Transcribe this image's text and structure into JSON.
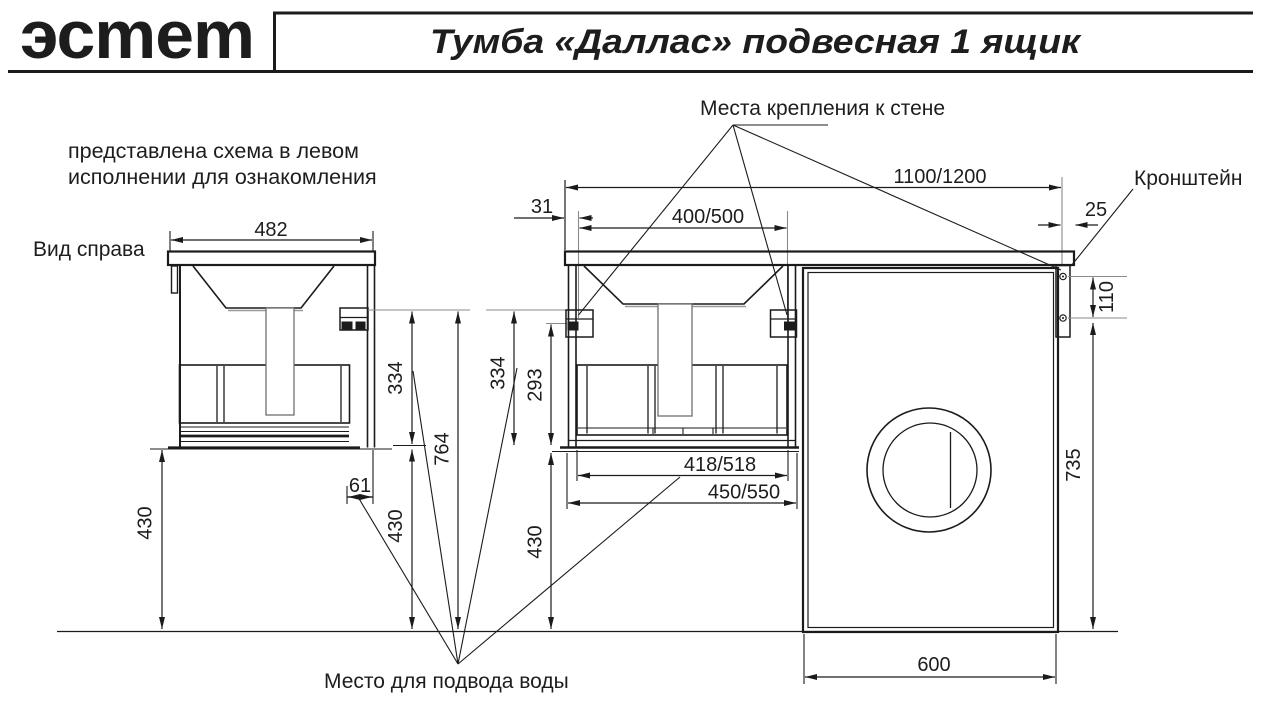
{
  "header": {
    "logo_text": "эсmеm",
    "title": "Тумба «Даллас» подвесная 1 ящик"
  },
  "note": {
    "line1": "представлена схема в левом",
    "line2": "исполнении для ознакомления"
  },
  "labels": {
    "view_right": "Вид справа",
    "wall_mount": "Места крепления к стене",
    "bracket": "Кронштейн",
    "water_supply": "Место для подвода воды"
  },
  "dims": {
    "side_width": "482",
    "side_depth_334": "334",
    "side_drain_offset_61": "61",
    "height_430_left": "430",
    "height_430_side": "430",
    "total_764": "764",
    "mount_inset_31": "31",
    "mount_spacing": "400/500",
    "total_width": "1100/1200",
    "bracket_offset_25": "25",
    "bracket_holes_110": "110",
    "front_depth_334": "334",
    "drawer_293": "293",
    "height_430_front": "430",
    "drawer_inner_width": "418/518",
    "cabinet_width": "450/550",
    "washer_height_735": "735",
    "washer_width_600": "600"
  },
  "colors": {
    "accent_note": "#c9504e",
    "line": "#1b1b1b",
    "extension": "#8a8a8a"
  }
}
